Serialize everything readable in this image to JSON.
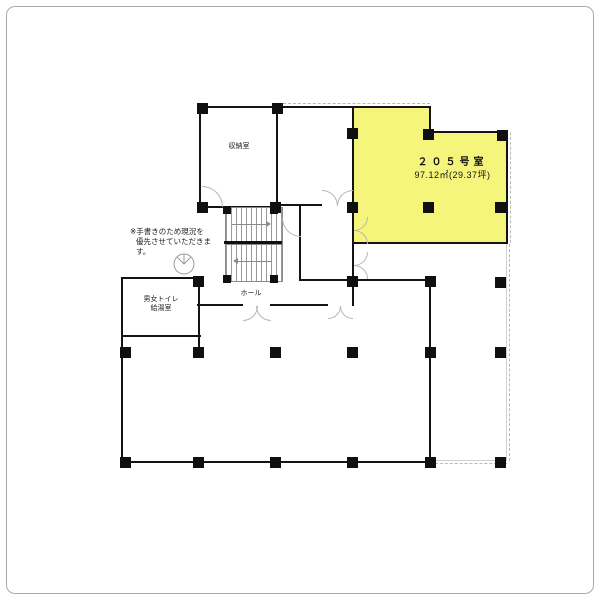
{
  "plan": {
    "note": {
      "line1": "※手書きのため現況を",
      "line2": "優先させていただきます。"
    },
    "rooms": {
      "room205": {
        "name": "２０５号室",
        "area": "97.12㎡(29.37坪)",
        "highlight_color": "#F5F57C"
      },
      "storage": {
        "label": "収納室"
      },
      "toilet": {
        "line1": "男女トイレ",
        "line2": "給湯室"
      },
      "hall": {
        "label": "ホール"
      }
    }
  }
}
